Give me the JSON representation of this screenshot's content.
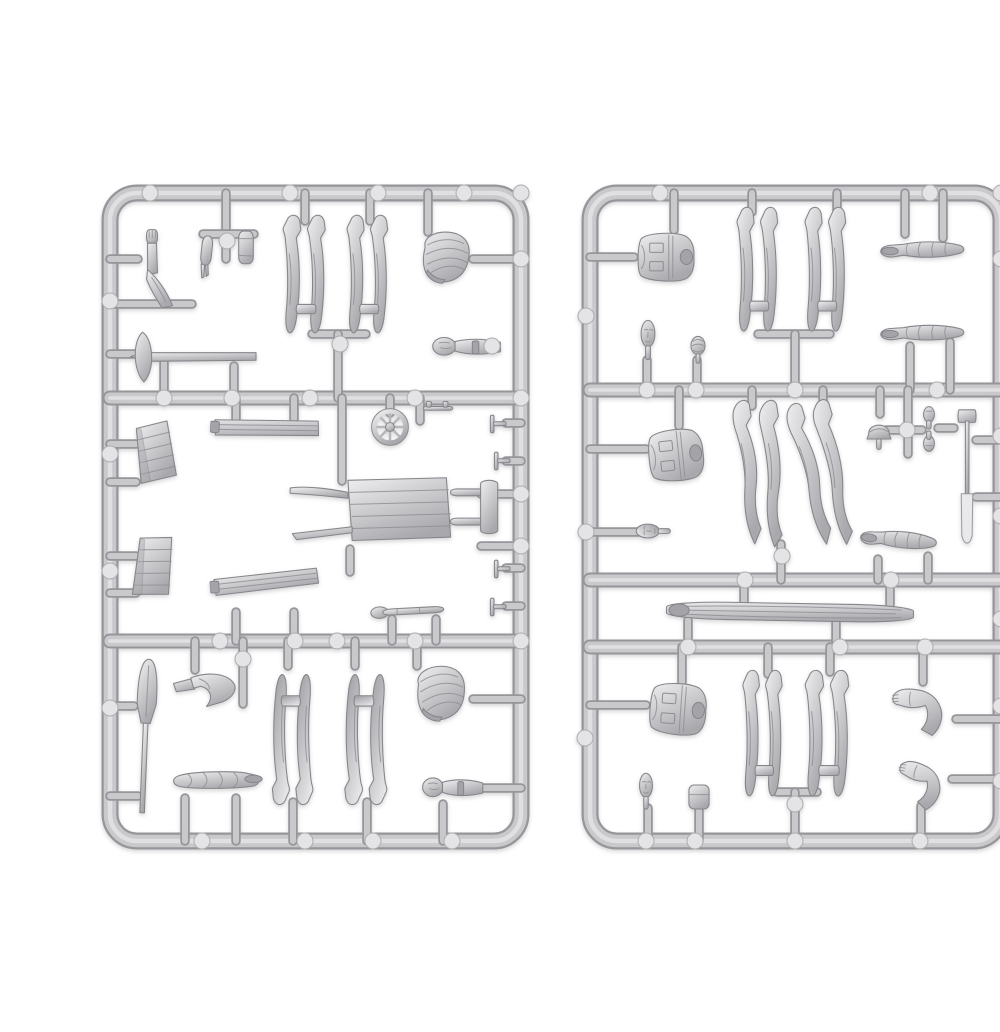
{
  "meta": {
    "title": "Model kit sprues with figure parts",
    "alt": "Product photo of two light-gray plastic model sprues containing miniature figure parts: legs, torsos, arms, heads, backpacks, a wheelbarrow, planks, crates, a wheel, shovels, a pickaxe and a log, on a white background."
  },
  "palette": {
    "background": "#ffffff",
    "runner_dark": "#95959a",
    "runner_mid": "#c9c9cc",
    "runner_light": "#e2e2e4",
    "part_stroke": "#85858a",
    "part_fill_light": "#efeff1",
    "part_fill_mid": "#cfcfd2",
    "part_fill_dark": "#a9a9ad",
    "pad_fill": "#e4e4e6"
  },
  "sprues": [
    {
      "name": "left-sprue",
      "frame": {
        "x": 70,
        "y": 177,
        "w": 411,
        "h": 648,
        "r": 27
      },
      "rails": [
        [
          70,
          382,
          481,
          382
        ],
        [
          70,
          625,
          481,
          625
        ]
      ],
      "stubs": [
        [
          186,
          177,
          186,
          243
        ],
        [
          163,
          218,
          214,
          218
        ],
        [
          265,
          177,
          265,
          205
        ],
        [
          330,
          177,
          330,
          205
        ],
        [
          388,
          177,
          388,
          216
        ],
        [
          433,
          243,
          481,
          243
        ],
        [
          272,
          318,
          326,
          318
        ],
        [
          298,
          318,
          298,
          382
        ],
        [
          70,
          243,
          98,
          243
        ],
        [
          70,
          288,
          152,
          288
        ],
        [
          70,
          338,
          94,
          338
        ],
        [
          124,
          346,
          124,
          382
        ],
        [
          194,
          350,
          194,
          382
        ],
        [
          70,
          428,
          96,
          428
        ],
        [
          70,
          466,
          96,
          466
        ],
        [
          196,
          382,
          196,
          403
        ],
        [
          254,
          382,
          254,
          403
        ],
        [
          350,
          382,
          350,
          397
        ],
        [
          380,
          382,
          380,
          405
        ],
        [
          466,
          407,
          481,
          407
        ],
        [
          466,
          445,
          481,
          445
        ],
        [
          302,
          382,
          302,
          465
        ],
        [
          441,
          478,
          481,
          478
        ],
        [
          441,
          530,
          481,
          530
        ],
        [
          310,
          533,
          310,
          556
        ],
        [
          70,
          540,
          96,
          540
        ],
        [
          70,
          577,
          96,
          577
        ],
        [
          196,
          596,
          196,
          625
        ],
        [
          254,
          596,
          254,
          625
        ],
        [
          352,
          603,
          352,
          625
        ],
        [
          396,
          603,
          396,
          625
        ],
        [
          466,
          552,
          481,
          552
        ],
        [
          466,
          590,
          481,
          590
        ],
        [
          70,
          690,
          94,
          690
        ],
        [
          70,
          780,
          98,
          780
        ],
        [
          155,
          625,
          155,
          654
        ],
        [
          203,
          625,
          203,
          688
        ],
        [
          248,
          625,
          248,
          650
        ],
        [
          315,
          625,
          315,
          650
        ],
        [
          377,
          625,
          377,
          650
        ],
        [
          433,
          683,
          481,
          683
        ],
        [
          253,
          786,
          253,
          825
        ],
        [
          327,
          786,
          327,
          825
        ],
        [
          145,
          782,
          145,
          825
        ],
        [
          196,
          782,
          196,
          825
        ],
        [
          430,
          772,
          481,
          772
        ],
        [
          403,
          788,
          403,
          825
        ]
      ],
      "pads": [
        [
          110,
          177
        ],
        [
          250,
          177
        ],
        [
          338,
          177
        ],
        [
          424,
          177
        ],
        [
          481,
          177
        ],
        [
          70,
          285
        ],
        [
          70,
          438
        ],
        [
          70,
          555
        ],
        [
          70,
          692
        ],
        [
          124,
          382
        ],
        [
          192,
          382
        ],
        [
          270,
          382
        ],
        [
          375,
          382
        ],
        [
          481,
          382
        ],
        [
          187,
          225
        ],
        [
          452,
          330
        ],
        [
          300,
          328
        ],
        [
          180,
          625
        ],
        [
          255,
          625
        ],
        [
          297,
          625
        ],
        [
          375,
          625
        ],
        [
          481,
          625
        ],
        [
          203,
          643
        ],
        [
          481,
          243
        ],
        [
          481,
          478
        ],
        [
          481,
          530
        ],
        [
          162,
          825
        ],
        [
          265,
          825
        ],
        [
          333,
          825
        ],
        [
          412,
          825
        ]
      ],
      "parts": [
        {
          "s": "arm-raised",
          "n": "raised-arm-part",
          "x": 92,
          "y": 212,
          "w": 52,
          "h": 80
        },
        {
          "s": "forearm",
          "n": "forearm-hand-part",
          "x": 153,
          "y": 218,
          "w": 26,
          "h": 46,
          "r": 6
        },
        {
          "s": "canteen",
          "n": "canteen-part",
          "x": 193,
          "y": 212,
          "w": 26,
          "h": 38
        },
        {
          "s": "legs-up",
          "n": "legs-part",
          "x": 240,
          "y": 198,
          "w": 58,
          "h": 133
        },
        {
          "s": "legs-up",
          "n": "legs-part",
          "x": 304,
          "y": 198,
          "w": 56,
          "h": 133
        },
        {
          "s": "backpack",
          "n": "backpack-part",
          "x": 374,
          "y": 212,
          "w": 62,
          "h": 60
        },
        {
          "s": "pickaxe",
          "n": "pickaxe-part",
          "x": 88,
          "y": 314,
          "w": 132,
          "h": 54
        },
        {
          "s": "head-arm",
          "n": "head-and-socket-part",
          "x": 392,
          "y": 314,
          "w": 72,
          "h": 34
        },
        {
          "s": "crate",
          "n": "crate-part",
          "x": 92,
          "y": 404,
          "w": 46,
          "h": 64,
          "r": -7
        },
        {
          "s": "plank",
          "n": "plank-part",
          "x": 170,
          "y": 396,
          "w": 112,
          "h": 40,
          "r": 3
        },
        {
          "s": "wheel",
          "n": "wheel-part",
          "x": 330,
          "y": 391,
          "w": 40,
          "h": 40
        },
        {
          "s": "bracket",
          "n": "bracket-part",
          "x": 382,
          "y": 383,
          "w": 32,
          "h": 17
        },
        {
          "s": "clip",
          "n": "clip-part",
          "x": 448,
          "y": 397,
          "w": 20,
          "h": 22
        },
        {
          "s": "clip",
          "n": "clip-part",
          "x": 452,
          "y": 434,
          "w": 20,
          "h": 22
        },
        {
          "s": "wheelbarrow",
          "n": "wheelbarrow-part",
          "x": 248,
          "y": 454,
          "w": 214,
          "h": 86
        },
        {
          "s": "crate",
          "n": "crate-part",
          "x": 90,
          "y": 517,
          "w": 46,
          "h": 66,
          "r": 6
        },
        {
          "s": "plank",
          "n": "plank-part",
          "x": 170,
          "y": 549,
          "w": 112,
          "h": 42,
          "r": -4
        },
        {
          "s": "toolbar",
          "n": "tool-part",
          "x": 330,
          "y": 584,
          "w": 80,
          "h": 22,
          "r": -3
        },
        {
          "s": "clip",
          "n": "clip-part",
          "x": 452,
          "y": 542,
          "w": 20,
          "h": 22
        },
        {
          "s": "clip",
          "n": "clip-part",
          "x": 448,
          "y": 580,
          "w": 20,
          "h": 22
        },
        {
          "s": "shovel",
          "n": "shovel-part",
          "x": 86,
          "y": 640,
          "w": 38,
          "h": 160,
          "r": 3
        },
        {
          "s": "bent-leg",
          "n": "bent-leg-part",
          "x": 132,
          "y": 650,
          "w": 72,
          "h": 46
        },
        {
          "s": "legs-up",
          "n": "legs-part",
          "x": 220,
          "y": 643,
          "w": 56,
          "h": 147,
          "r": 180
        },
        {
          "s": "legs-up",
          "n": "legs-part",
          "x": 292,
          "y": 643,
          "w": 58,
          "h": 147,
          "r": 180
        },
        {
          "s": "backpack",
          "n": "backpack-part",
          "x": 368,
          "y": 646,
          "w": 64,
          "h": 64,
          "r": -5
        },
        {
          "s": "bedroll",
          "n": "bedroll-part",
          "x": 130,
          "y": 750,
          "w": 96,
          "h": 34
        },
        {
          "s": "head-arm",
          "n": "head-and-socket-part",
          "x": 382,
          "y": 754,
          "w": 64,
          "h": 36
        }
      ]
    },
    {
      "name": "right-sprue",
      "frame": {
        "x": 550,
        "y": 177,
        "w": 411,
        "h": 648,
        "r": 27
      },
      "rails": [
        [
          550,
          374,
          961,
          374
        ],
        [
          550,
          564,
          961,
          564
        ],
        [
          550,
          631,
          961,
          631
        ]
      ],
      "stubs": [
        [
          634,
          177,
          634,
          214
        ],
        [
          550,
          241,
          594,
          241
        ],
        [
          712,
          177,
          712,
          196
        ],
        [
          797,
          177,
          797,
          196
        ],
        [
          718,
          318,
          790,
          318
        ],
        [
          755,
          318,
          755,
          374
        ],
        [
          865,
          177,
          865,
          218
        ],
        [
          903,
          177,
          903,
          222
        ],
        [
          870,
          330,
          870,
          374
        ],
        [
          910,
          326,
          910,
          374
        ],
        [
          607,
          344,
          607,
          374
        ],
        [
          657,
          344,
          657,
          374
        ],
        [
          639,
          374,
          639,
          410
        ],
        [
          550,
          433,
          606,
          433
        ],
        [
          712,
          374,
          712,
          390
        ],
        [
          783,
          374,
          783,
          390
        ],
        [
          741,
          528,
          741,
          564
        ],
        [
          840,
          374,
          840,
          398
        ],
        [
          868,
          374,
          868,
          438
        ],
        [
          846,
          414,
          882,
          414
        ],
        [
          898,
          412,
          914,
          412
        ],
        [
          936,
          424,
          961,
          424
        ],
        [
          936,
          481,
          961,
          481
        ],
        [
          550,
          516,
          602,
          516
        ],
        [
          838,
          543,
          838,
          564
        ],
        [
          888,
          540,
          888,
          564
        ],
        [
          704,
          564,
          704,
          589
        ],
        [
          850,
          564,
          850,
          589
        ],
        [
          648,
          604,
          648,
          631
        ],
        [
          796,
          604,
          796,
          631
        ],
        [
          642,
          631,
          642,
          666
        ],
        [
          550,
          689,
          606,
          689
        ],
        [
          728,
          631,
          728,
          658
        ],
        [
          790,
          631,
          790,
          656
        ],
        [
          883,
          631,
          883,
          666
        ],
        [
          916,
          703,
          961,
          703
        ],
        [
          737,
          776,
          777,
          776
        ],
        [
          755,
          776,
          755,
          825
        ],
        [
          608,
          792,
          608,
          825
        ],
        [
          659,
          792,
          659,
          825
        ],
        [
          912,
          763,
          961,
          763
        ],
        [
          881,
          790,
          881,
          825
        ]
      ],
      "pads": [
        [
          620,
          177
        ],
        [
          890,
          177
        ],
        [
          961,
          177
        ],
        [
          961,
          243
        ],
        [
          961,
          420
        ],
        [
          961,
          500
        ],
        [
          961,
          603
        ],
        [
          961,
          690
        ],
        [
          961,
          765
        ],
        [
          546,
          300
        ],
        [
          545,
          722
        ],
        [
          546,
          516
        ],
        [
          607,
          374
        ],
        [
          656,
          374
        ],
        [
          755,
          374
        ],
        [
          897,
          374
        ],
        [
          867,
          414
        ],
        [
          742,
          540
        ],
        [
          705,
          564
        ],
        [
          851,
          564
        ],
        [
          648,
          631
        ],
        [
          800,
          631
        ],
        [
          885,
          631
        ],
        [
          755,
          788
        ],
        [
          606,
          825
        ],
        [
          655,
          825
        ],
        [
          755,
          825
        ],
        [
          880,
          825
        ]
      ],
      "parts": [
        {
          "s": "torso-side",
          "n": "torso-part",
          "x": 592,
          "y": 212,
          "w": 68,
          "h": 58
        },
        {
          "s": "legs-up",
          "n": "legs-part",
          "x": 694,
          "y": 190,
          "w": 56,
          "h": 140
        },
        {
          "s": "legs-up",
          "n": "legs-part",
          "x": 762,
          "y": 190,
          "w": 56,
          "h": 140
        },
        {
          "s": "arm-sleeve",
          "n": "arm-part",
          "x": 838,
          "y": 214,
          "w": 92,
          "h": 42
        },
        {
          "s": "arm-sleeve",
          "n": "arm-part",
          "x": 838,
          "y": 298,
          "w": 92,
          "h": 40
        },
        {
          "s": "head",
          "n": "head-part",
          "x": 593,
          "y": 303,
          "w": 30,
          "h": 46
        },
        {
          "s": "ball",
          "n": "round-part",
          "x": 644,
          "y": 316,
          "w": 28,
          "h": 34
        },
        {
          "s": "torso-side",
          "n": "torso-part",
          "x": 603,
          "y": 408,
          "w": 66,
          "h": 62,
          "r": -6
        },
        {
          "s": "legs-bent",
          "n": "legs-part",
          "x": 690,
          "y": 382,
          "w": 62,
          "h": 152
        },
        {
          "s": "legs-bent",
          "n": "legs-part",
          "x": 752,
          "y": 382,
          "w": 62,
          "h": 152,
          "r": -8
        },
        {
          "s": "cap",
          "n": "cap-part",
          "x": 824,
          "y": 395,
          "w": 30,
          "h": 40
        },
        {
          "s": "hands",
          "n": "hands-part",
          "x": 874,
          "y": 388,
          "w": 30,
          "h": 52
        },
        {
          "s": "spade",
          "n": "spade-part",
          "x": 911,
          "y": 391,
          "w": 32,
          "h": 140
        },
        {
          "s": "head",
          "n": "head-part",
          "x": 600,
          "y": 495,
          "w": 30,
          "h": 40,
          "r": -90
        },
        {
          "s": "arm-sleeve",
          "n": "arm-part",
          "x": 818,
          "y": 503,
          "w": 84,
          "h": 44,
          "r": 6
        },
        {
          "s": "log",
          "n": "log-part",
          "x": 624,
          "y": 584,
          "w": 252,
          "h": 24,
          "r": 1
        },
        {
          "s": "torso-side",
          "n": "torso-part",
          "x": 604,
          "y": 662,
          "w": 68,
          "h": 62,
          "r": 4
        },
        {
          "s": "legs-up",
          "n": "legs-part",
          "x": 700,
          "y": 653,
          "w": 54,
          "h": 142
        },
        {
          "s": "legs-up",
          "n": "legs-part",
          "x": 762,
          "y": 653,
          "w": 60,
          "h": 142
        },
        {
          "s": "arm-bent",
          "n": "bent-arm-part",
          "x": 850,
          "y": 663,
          "w": 68,
          "h": 60
        },
        {
          "s": "head",
          "n": "head-part",
          "x": 592,
          "y": 756,
          "w": 28,
          "h": 42
        },
        {
          "s": "pouch",
          "n": "pouch-part",
          "x": 645,
          "y": 766,
          "w": 28,
          "h": 30
        },
        {
          "s": "arm-bent",
          "n": "bent-arm-part",
          "x": 854,
          "y": 740,
          "w": 62,
          "h": 56,
          "r": 15
        }
      ]
    }
  ]
}
